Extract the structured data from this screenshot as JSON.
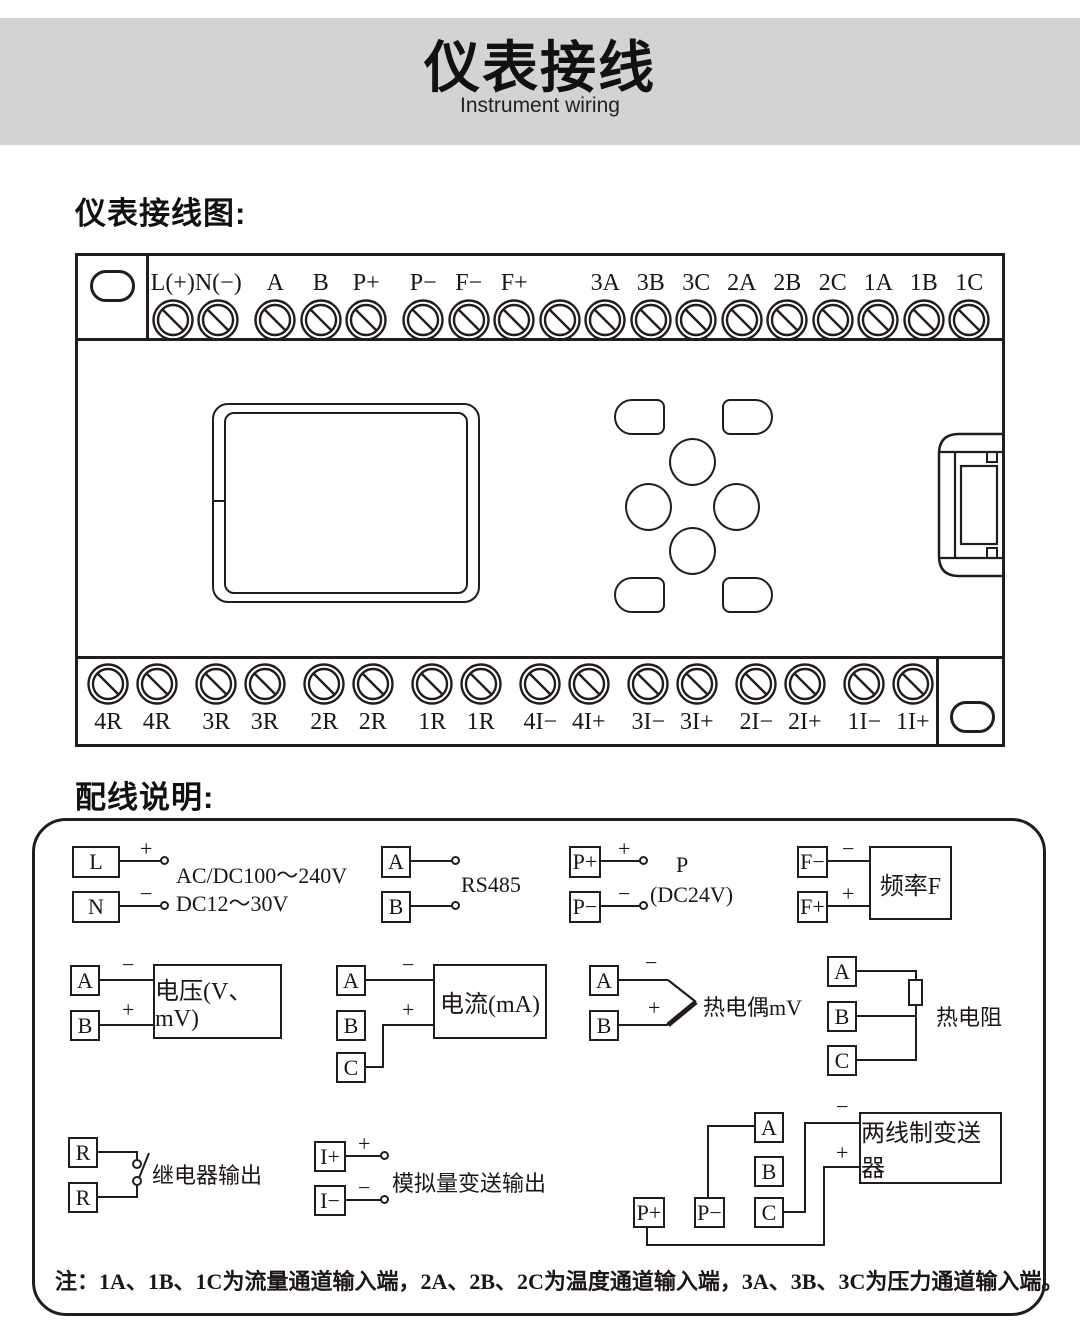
{
  "header": {
    "title": "仪表接线",
    "subtitle": "Instrument wiring"
  },
  "headings": {
    "diagram": "仪表接线图:",
    "wiring": "配线说明:"
  },
  "terminal_block": {
    "top": [
      "L(+)",
      "N(−)",
      "A",
      "B",
      "P+",
      "P−",
      "F−",
      "F+",
      "",
      "3A",
      "3B",
      "3C",
      "2A",
      "2B",
      "2C",
      "1A",
      "1B",
      "1C"
    ],
    "bottom": [
      "4R",
      "4R",
      "3R",
      "3R",
      "2R",
      "2R",
      "1R",
      "1R",
      "4I−",
      "4I+",
      "3I−",
      "3I+",
      "2I−",
      "2I+",
      "1I−",
      "1I+"
    ]
  },
  "wiring": {
    "power": {
      "l": "L",
      "n": "N",
      "plus": "+",
      "minus": "−",
      "line1": "AC/DC100～240V",
      "line2": "DC12～30V"
    },
    "rs485": {
      "a": "A",
      "b": "B",
      "label": "RS485"
    },
    "p_supply": {
      "pp": "P+",
      "pm": "P−",
      "plus": "+",
      "minus": "−",
      "name": "P",
      "volt": "(DC24V)"
    },
    "frequency": {
      "fm": "F−",
      "fp": "F+",
      "plus": "+",
      "minus": "−",
      "box": "频率F"
    },
    "voltage": {
      "a": "A",
      "b": "B",
      "plus": "+",
      "minus": "−",
      "box": "电压(V、mV)"
    },
    "current": {
      "a": "A",
      "b": "B",
      "c": "C",
      "plus": "+",
      "minus": "−",
      "box": "电流(mA)"
    },
    "thermocouple": {
      "a": "A",
      "b": "B",
      "plus": "+",
      "minus": "−",
      "label": "热电偶mV"
    },
    "rtd": {
      "a": "A",
      "b": "B",
      "c": "C",
      "label": "热电阻"
    },
    "relay": {
      "r1": "R",
      "r2": "R",
      "label": "继电器输出"
    },
    "analog_out": {
      "ip": "I+",
      "im": "I−",
      "plus": "+",
      "minus": "−",
      "label": "模拟量变送输出"
    },
    "transmitter": {
      "a": "A",
      "b": "B",
      "c": "C",
      "pp": "P+",
      "pm": "P−",
      "plus": "+",
      "minus": "−",
      "box": "两线制变送器"
    }
  },
  "note": "注：1A、1B、1C为流量通道输入端，2A、2B、2C为温度通道输入端，3A、3B、3C为压力通道输入端。"
}
